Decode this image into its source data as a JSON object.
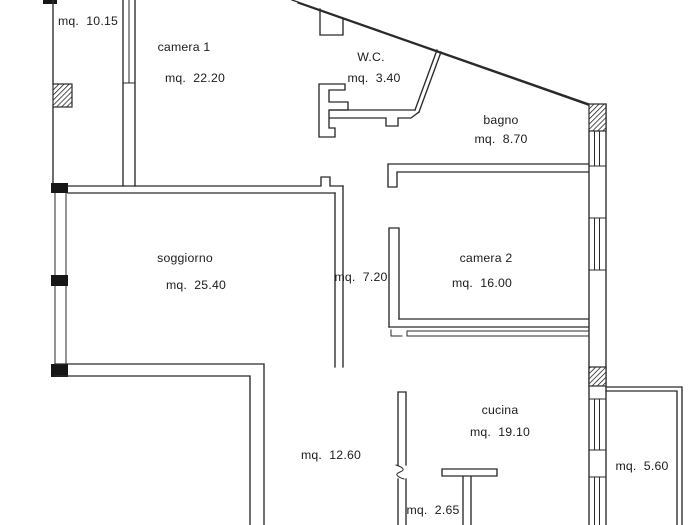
{
  "colors": {
    "background": "#ffffff",
    "walls": "#2a2a2a",
    "text": "#1c1c1c",
    "pillar_fill": "#161616"
  },
  "rooms": {
    "storage": {
      "area": "mq.  10.15"
    },
    "camera1": {
      "name": "camera 1",
      "area": "mq.  22.20"
    },
    "wc": {
      "name": "W.C.",
      "area": "mq.  3.40"
    },
    "bagno": {
      "name": "bagno",
      "area": "mq.  8.70"
    },
    "soggiorno": {
      "name": "soggiorno",
      "area": "mq.  25.40"
    },
    "corridoio": {
      "area": "mq.  7.20"
    },
    "camera2": {
      "name": "camera 2",
      "area": "mq.  16.00"
    },
    "cucina": {
      "name": "cucina",
      "area": "mq.  19.10"
    },
    "disimpegno": {
      "area": "mq.  12.60"
    },
    "ripostiglio": {
      "area": "mq.  2.65"
    },
    "balcone": {
      "area": "mq.  5.60"
    }
  }
}
